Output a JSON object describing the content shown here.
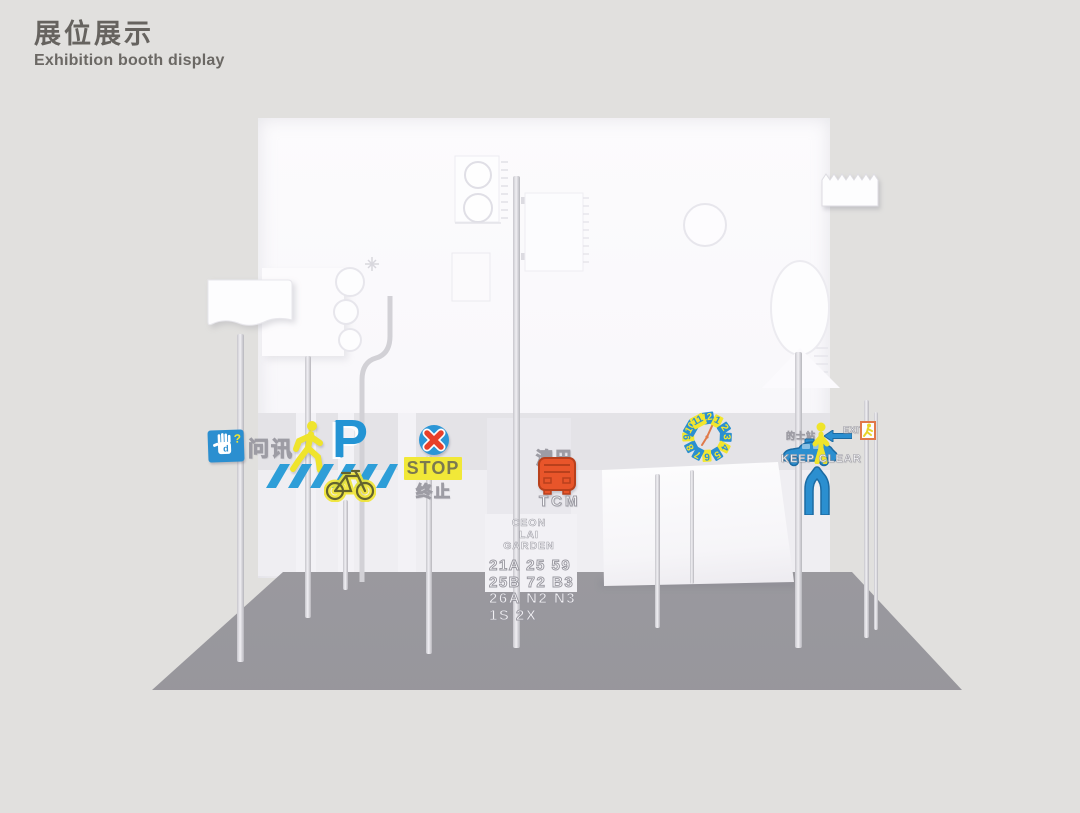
{
  "header": {
    "title_zh": "展位展示",
    "title_en": "Exhibition booth display"
  },
  "signs": {
    "info": {
      "label": "问讯",
      "question_mark": "?"
    },
    "parking": {
      "letter": "P"
    },
    "stop": {
      "word": "STOP",
      "word_zh": "终止"
    },
    "bus": {
      "name_zh": "澳巴",
      "name_en": "TCM"
    },
    "clock": {
      "numbers": [
        "12",
        "1",
        "2",
        "3",
        "4",
        "5",
        "6",
        "7",
        "8",
        "9",
        "10",
        "11"
      ]
    },
    "taxi": {
      "label": "的士站"
    },
    "exit": {
      "label": "EXIT"
    },
    "keep_clear": {
      "label": "KEEP CLEAR"
    }
  },
  "bus_stop": {
    "name_lines": [
      "CEON",
      "LAI",
      "GARDEN"
    ],
    "route_rows": [
      "21A 25 59",
      "25B 72 B3",
      "26A N2 N3",
      "1S 2X"
    ]
  },
  "colors": {
    "accent_blue": "#2b8fd0",
    "accent_yellow": "#f2e62e",
    "accent_red": "#e8402a",
    "accent_orange": "#e8552a",
    "wall": "#fbfafc",
    "floor": "#9c9ba0",
    "background": "#e1e0de",
    "title_text": "#66635f"
  }
}
